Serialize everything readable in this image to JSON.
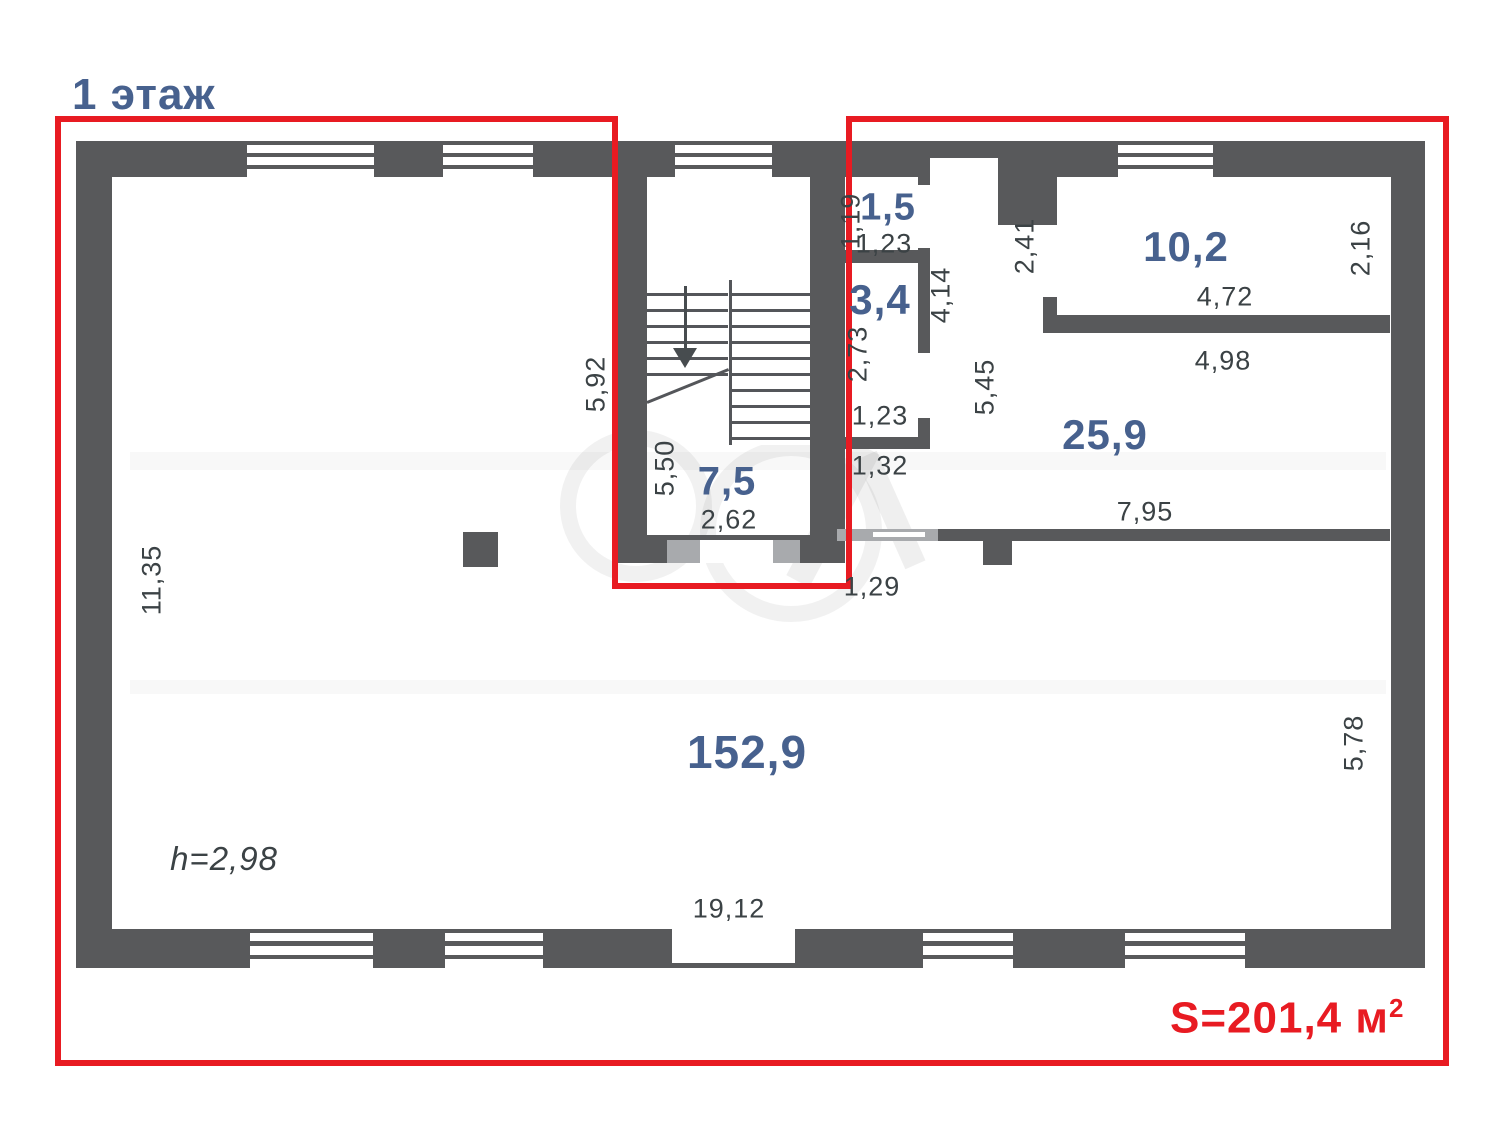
{
  "page": {
    "title": "1 этаж",
    "total_area_text": "S=201,4 м",
    "total_area_sup": "2"
  },
  "colors": {
    "wall": "#58595b",
    "wall_light": "#a8aaad",
    "boundary_red": "#e81b22",
    "room_label_blue": "#47618e",
    "dimension_text": "#3b4245",
    "background": "#ffffff"
  },
  "icons": [
    {
      "name": "stairs-down-arrow-icon",
      "meaning": "direction of stair descent"
    }
  ],
  "rooms": [
    {
      "area": "1,5",
      "x": 888,
      "y": 208,
      "size": 38
    },
    {
      "area": "3,4",
      "x": 880,
      "y": 300,
      "size": 42
    },
    {
      "area": "10,2",
      "x": 1186,
      "y": 247,
      "size": 42
    },
    {
      "area": "25,9",
      "x": 1105,
      "y": 435,
      "size": 42
    },
    {
      "area": "7,5",
      "x": 727,
      "y": 482,
      "size": 40
    },
    {
      "area": "152,9",
      "x": 747,
      "y": 752,
      "size": 46
    }
  ],
  "dimensions": [
    {
      "v": "1,19",
      "x": 851,
      "y": 221,
      "rot": true
    },
    {
      "v": "1,23",
      "x": 884,
      "y": 244,
      "rot": false
    },
    {
      "v": "2,73",
      "x": 858,
      "y": 354,
      "rot": true
    },
    {
      "v": "1,23",
      "x": 880,
      "y": 416,
      "rot": false
    },
    {
      "v": "1,32",
      "x": 880,
      "y": 466,
      "rot": false
    },
    {
      "v": "4,14",
      "x": 941,
      "y": 295,
      "rot": true
    },
    {
      "v": "2,41",
      "x": 1025,
      "y": 246,
      "rot": true
    },
    {
      "v": "5,45",
      "x": 985,
      "y": 387,
      "rot": true
    },
    {
      "v": "4,72",
      "x": 1225,
      "y": 297,
      "rot": false
    },
    {
      "v": "2,16",
      "x": 1361,
      "y": 248,
      "rot": true
    },
    {
      "v": "4,98",
      "x": 1223,
      "y": 361,
      "rot": false
    },
    {
      "v": "7,95",
      "x": 1145,
      "y": 512,
      "rot": false
    },
    {
      "v": "5,92",
      "x": 596,
      "y": 384,
      "rot": true
    },
    {
      "v": "5,50",
      "x": 665,
      "y": 468,
      "rot": true
    },
    {
      "v": "2,62",
      "x": 729,
      "y": 520,
      "rot": false
    },
    {
      "v": "1,29",
      "x": 872,
      "y": 587,
      "rot": false
    },
    {
      "v": "11,35",
      "x": 152,
      "y": 580,
      "rot": true
    },
    {
      "v": "5,78",
      "x": 1354,
      "y": 743,
      "rot": true
    },
    {
      "v": "h=2,98",
      "x": 224,
      "y": 859,
      "rot": false,
      "it": true
    },
    {
      "v": "19,12",
      "x": 729,
      "y": 909,
      "rot": false
    }
  ]
}
